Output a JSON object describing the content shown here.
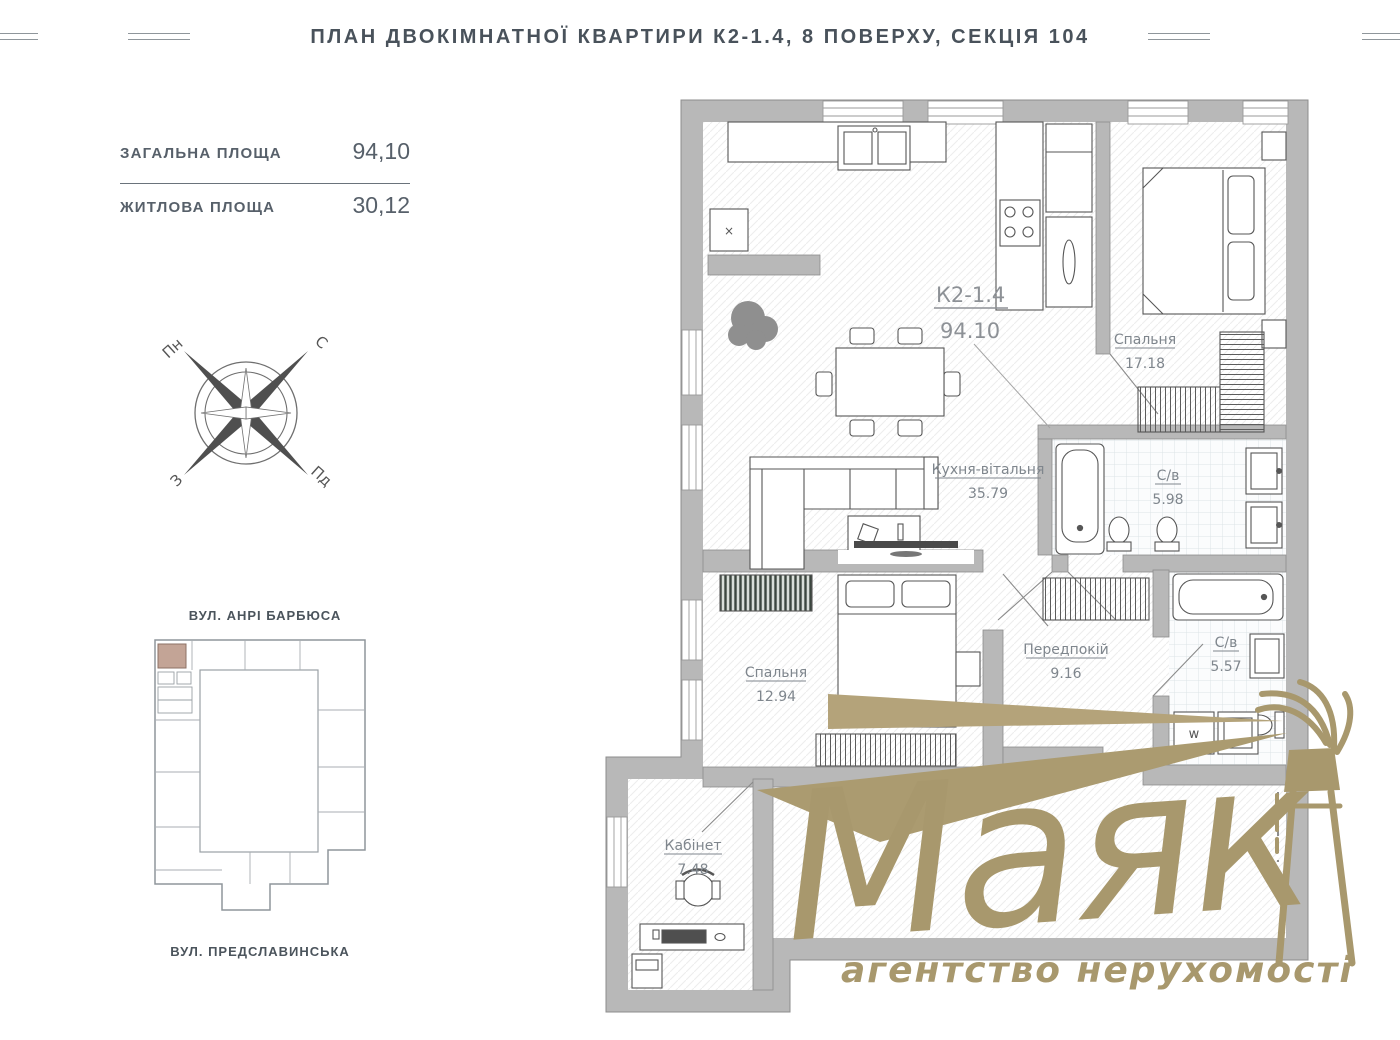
{
  "header": {
    "title": "ПЛАН ДВОКІМНАТНОЇ КВАРТИРИ К2-1.4, 8 ПОВЕРХУ, СЕКЦІЯ 104"
  },
  "summary": {
    "rows": [
      {
        "label": "ЗАГАЛЬНА ПЛОЩА",
        "value": "94,10"
      },
      {
        "label": "ЖИТЛОВА ПЛОЩА",
        "value": "30,12"
      }
    ]
  },
  "compass": {
    "north": "Пн",
    "south": "Пд",
    "east": "С",
    "west": "З"
  },
  "site_map": {
    "street_top": "ВУЛ. АНРІ БАРБЮСА",
    "street_bottom": "ВУЛ. ПРЕДСЛАВИНСЬКА",
    "highlight_color": "#c3a496"
  },
  "plan": {
    "unit_code": "К2-1.4",
    "unit_area": "94.10",
    "washer_label": "w",
    "appliance_mark": "×",
    "rooms": [
      {
        "name": "Спальня",
        "area": "17.18"
      },
      {
        "name": "С/в",
        "area": "5.98"
      },
      {
        "name": "Кухня-вітальня",
        "area": "35.79"
      },
      {
        "name": "Спальня",
        "area": "12.94"
      },
      {
        "name": "Передпокій",
        "area": "9.16"
      },
      {
        "name": "С/в",
        "area": "5.57"
      },
      {
        "name": "Кабінет",
        "area": "7.48"
      }
    ]
  },
  "logo": {
    "brand": "Маяк",
    "tagline": "агентство нерухомості",
    "color": "#a8986d"
  },
  "colors": {
    "wall": "#b8b8b8",
    "wall_line": "#8d8d8d",
    "label": "#7f868d",
    "accent_gold": "#a8986d"
  }
}
